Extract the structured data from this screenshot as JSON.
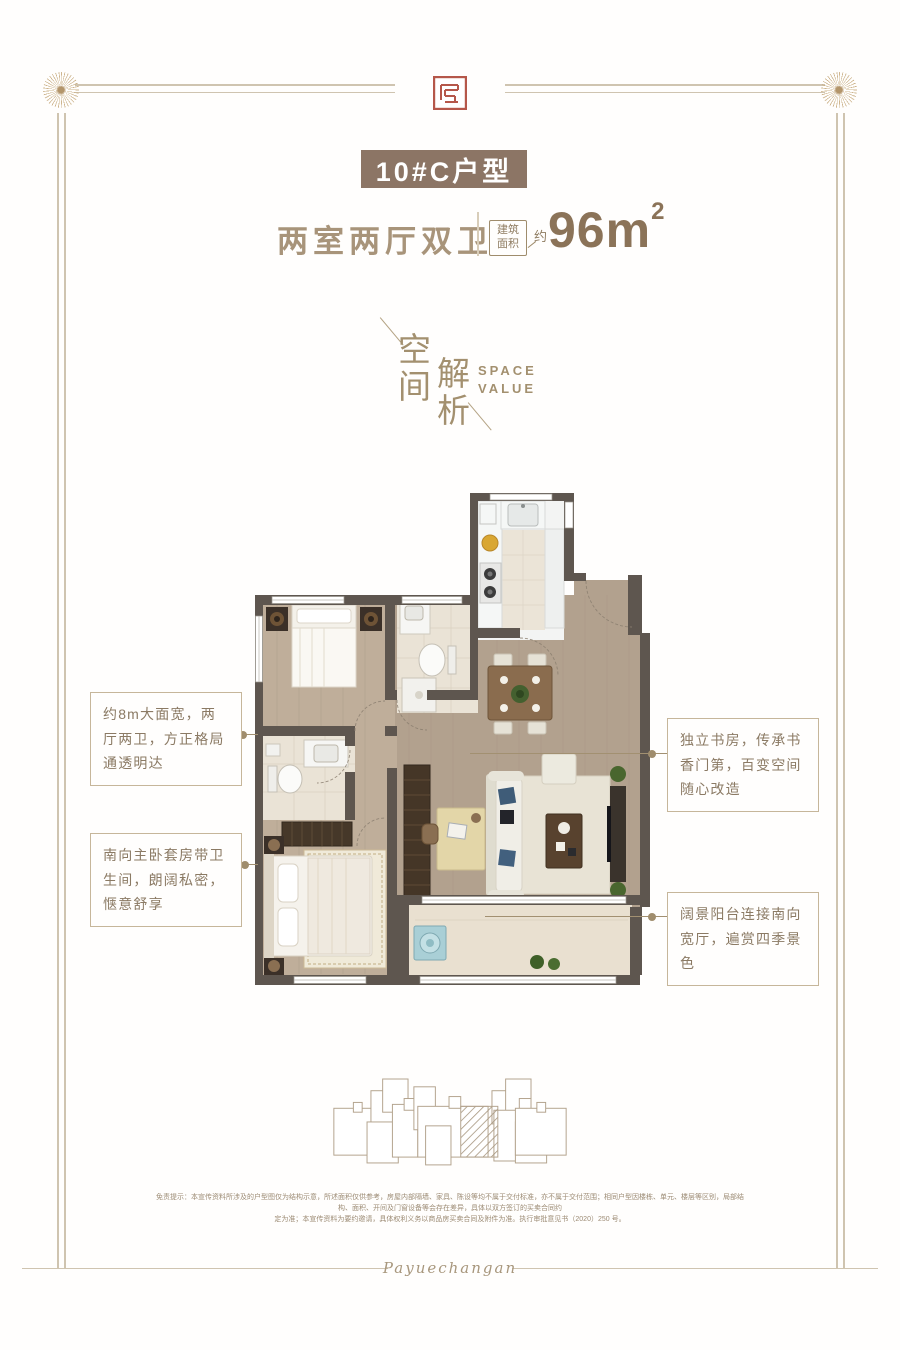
{
  "header": {
    "banner": "10#C户型",
    "subtitle": "两室两厅双卫",
    "area_label_top": "建筑",
    "area_label_bottom": "面积",
    "area_prefix": "约",
    "area_number": "96m",
    "area_exponent": "2"
  },
  "section_mark": {
    "cn_first": "空间",
    "cn_second": "解析",
    "en_first": "SPACE",
    "en_second": "VALUE"
  },
  "callouts": {
    "left_top": "约8m大面宽，两厅两卫，方正格局通透明达",
    "left_bottom": "南向主卧套房带卫生间，朗阔私密，惬意舒享",
    "right_top": "独立书房，传承书香门第，百变空间随心改造",
    "right_bottom": "阔景阳台连接南向宽厅，遍赏四季景色"
  },
  "footer": {
    "disclaimer_line1": "免责提示：本宣传资料所涉及的户型图仅为结构示意，所述面积仅供参考，房屋内部隔墙、家具、陈设等均不属于交付标准，亦不属于交付范围；相同户型因楼栋、单元、楼层等区别，局部结构、面积、开间及门窗设备等会存在差异，具体以双方签订的买卖合同约",
    "disclaimer_line2": "定为准；本宣传资料为要约邀请，具体权利义务以商品房买卖合同及附件为准。执行审批意见书（2020）250 号。",
    "signature": "Payuechangan"
  },
  "colors": {
    "accent_tan": "#a3906f",
    "banner_bg": "#8c7565",
    "seal_red": "#b5574a",
    "wall": "#5e564f",
    "wood_floor": "#b2a18e",
    "tile": "#eae3d6"
  }
}
